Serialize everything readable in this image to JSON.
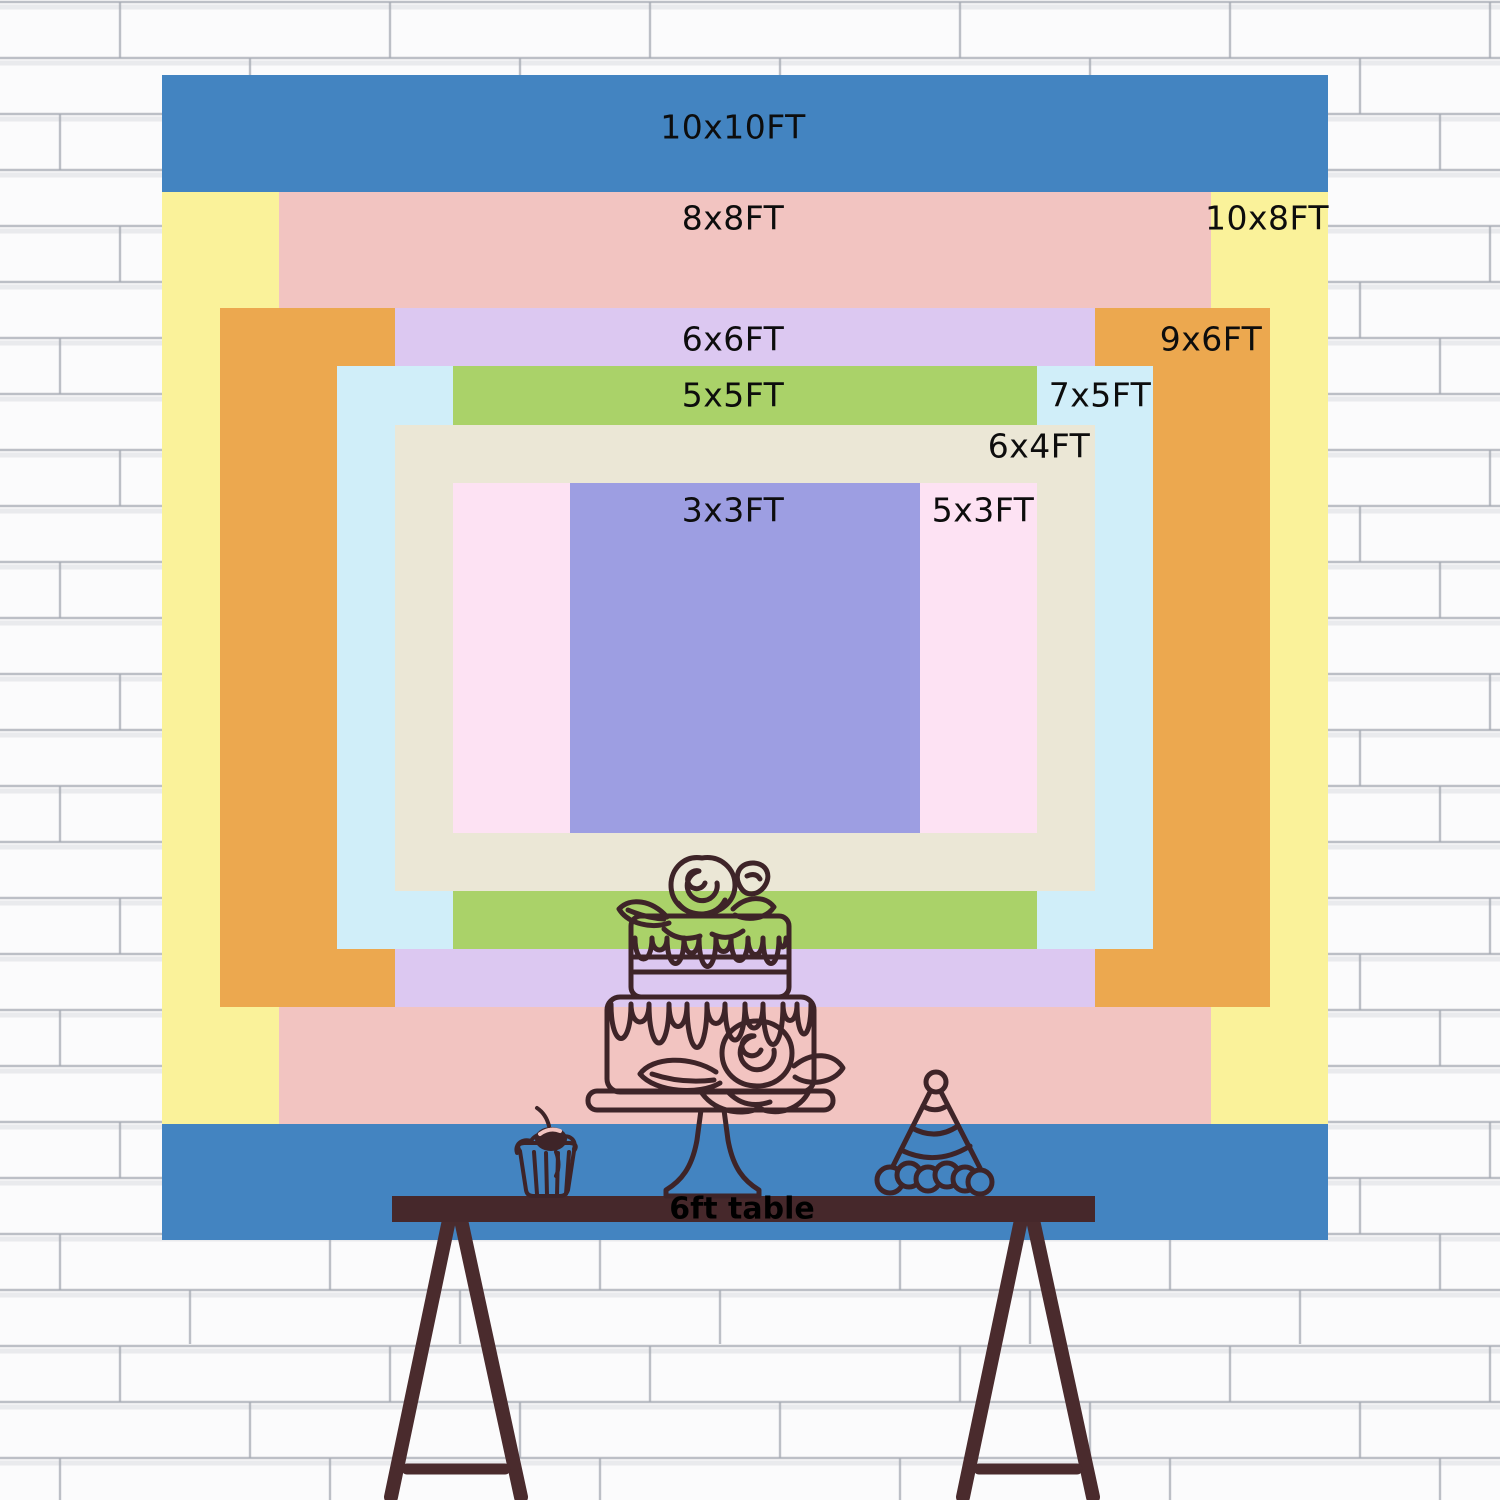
{
  "backdrop": {
    "sizes": [
      {
        "id": "10x10",
        "label": "10x10FT",
        "color": "#4384c1"
      },
      {
        "id": "10x8",
        "label": "10x8FT",
        "color": "#faf29a"
      },
      {
        "id": "8x8",
        "label": "8x8FT",
        "color": "#f2c4c1"
      },
      {
        "id": "9x6",
        "label": "9x6FT",
        "color": "#eca84f"
      },
      {
        "id": "6x6",
        "label": "6x6FT",
        "color": "#dcc8f1"
      },
      {
        "id": "7x5",
        "label": "7x5FT",
        "color": "#d0eef9"
      },
      {
        "id": "5x5",
        "label": "5x5FT",
        "color": "#aad269"
      },
      {
        "id": "6x4",
        "label": "6x4FT",
        "color": "#ebe7d6"
      },
      {
        "id": "5x3",
        "label": "5x3FT",
        "color": "#fde2f3"
      },
      {
        "id": "3x3",
        "label": "3x3FT",
        "color": "#9d9ee2"
      }
    ],
    "table_label": "6ft table"
  },
  "colors": {
    "wall_bg": "#fbfbfc",
    "mortar_line": "#a6abb4",
    "line_art": "#3e2428",
    "table_top": "#46282b",
    "table_legs": "#4a2b2d",
    "label_text": "#0d0d0d"
  },
  "illustrations": {
    "cake": "two-tier-drip-cake-with-roses-line-art",
    "cupcake": "cupcake-with-cherry-line-art",
    "party_hat": "striped-party-hat-line-art",
    "table": "trestle-table-line-art",
    "wall": "white-brick-wall-background"
  }
}
